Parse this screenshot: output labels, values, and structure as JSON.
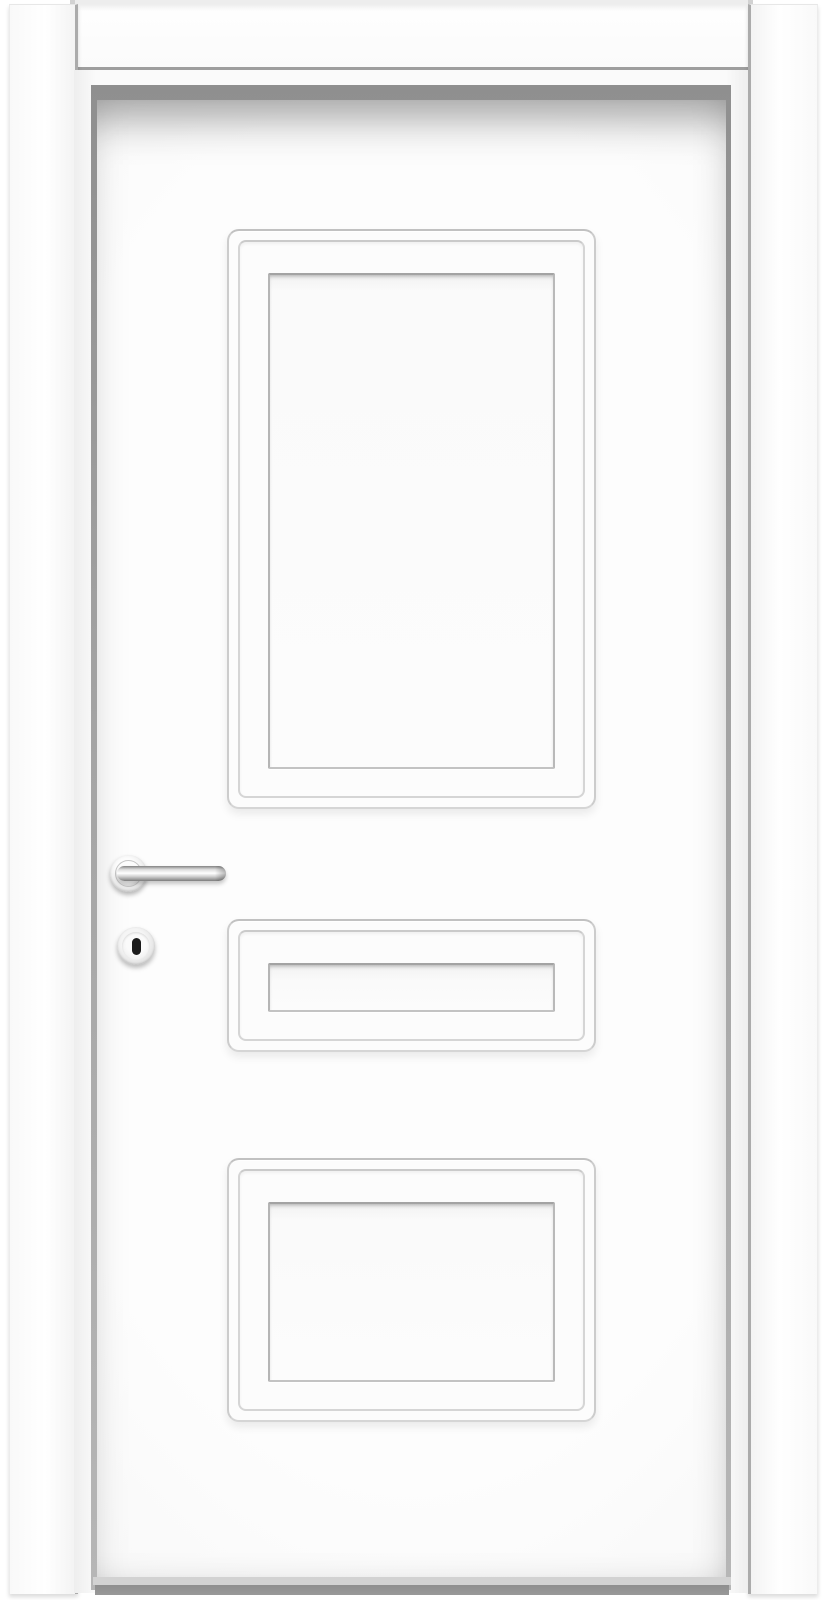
{
  "scene": {
    "type": "product-photo",
    "subject": "Closed white interior door with three recessed panels, mounted in a white frame with casing",
    "parts": {
      "frame_head": {
        "label": "White head casing board above the door"
      },
      "frame_left": {
        "label": "White left casing board"
      },
      "frame_right": {
        "label": "White right casing board"
      },
      "jamb": {
        "label": "White door jamb reveal"
      },
      "rebate": {
        "label": "Dark shadow gap between jamb and door leaf"
      },
      "door_leaf": {
        "label": "White door leaf with three recessed rectangular panels"
      },
      "panels": [
        {
          "label": "Large vertical recessed panel (top)"
        },
        {
          "label": "Narrow horizontal recessed panel (middle)"
        },
        {
          "label": "Wide horizontal recessed panel (bottom)"
        }
      ],
      "handle": {
        "label": "Stainless steel lever handle on round rosette, pointing right"
      },
      "rosette": {
        "label": "Round handle rosette plate"
      },
      "lever": {
        "label": "Straight tubular lever bar"
      },
      "escutcheon": {
        "label": "Round key escutcheon below the handle"
      },
      "keyhole": {
        "label": "Black keyhole slot"
      },
      "floor_gap_light": {
        "label": "Light gray gap strip under the door"
      },
      "floor_gap_dark": {
        "label": "Dark gray floor shadow strip under the door"
      }
    },
    "colors": {
      "background": "#ffffff",
      "door_white": "#fdfdfd",
      "trim_top": "#ededed",
      "edge_line": "#9e9e9e",
      "edge_line2": "#ababab",
      "recess_shadow": "#8f8f8f",
      "bottom_gap_light": "#d2d2d2",
      "bottom_gap_dark": "#8e8e8e",
      "metal_dark": "#828282",
      "keyhole": "#1b1b1b"
    }
  }
}
